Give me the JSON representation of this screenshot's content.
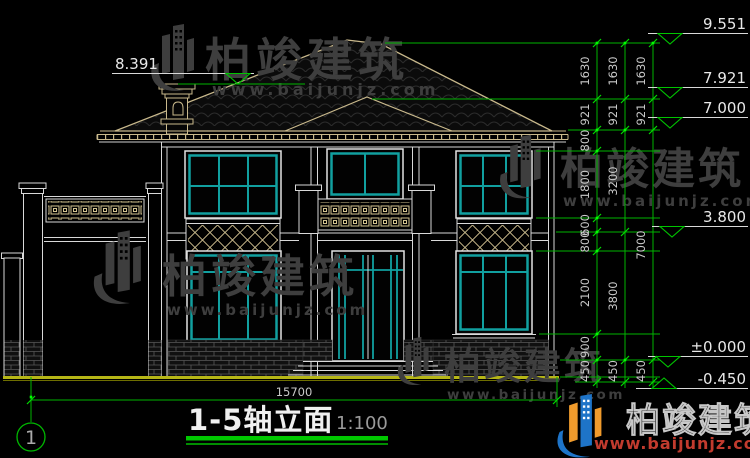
{
  "drawing_title": {
    "text": "1-5轴立面",
    "scale": "1:100"
  },
  "axis": {
    "bubble_1": "1"
  },
  "dims": {
    "overall_width": "15700",
    "col_inner": [
      "1630",
      "921",
      "800",
      "1800",
      "600",
      "800",
      "2100",
      "900",
      "450"
    ],
    "col_mid": [
      "1630",
      "921",
      "3200",
      "3800",
      "450"
    ],
    "col_outer": [
      "1630",
      "921",
      "7000",
      "450"
    ]
  },
  "elevations": {
    "left_chimney": "8.391",
    "right": [
      "9.551",
      "7.921",
      "7.000",
      "3.800",
      "±0.000",
      "-0.450"
    ]
  },
  "watermark": {
    "brand": "柏竣建筑",
    "website": "www.baijunjz.com"
  },
  "footer_logo": {
    "brand": "柏竣建筑",
    "website": "www.baijunjz.com"
  },
  "colors": {
    "dim_green": "#00b400",
    "window_teal": "#11a0a0",
    "detail_tan": "#c9b98c",
    "ground_olive": "#b6b616",
    "watermark_gray": "#3e3e3e",
    "logo_blue": "#1e74c8",
    "logo_orange": "#f09b2c",
    "logo_red": "#c23b2e"
  }
}
